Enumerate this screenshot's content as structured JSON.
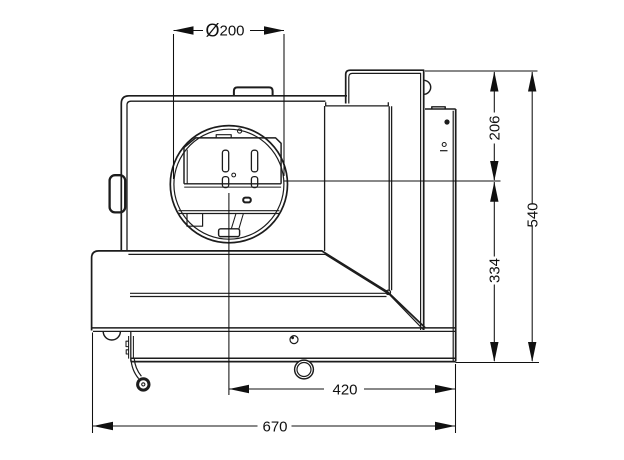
{
  "drawing": {
    "type": "technical-dimension-drawing",
    "subject": "stove side view with flue outlet",
    "colors": {
      "background": "#ffffff",
      "line": "#1c1c1c",
      "dimension": "#101010"
    },
    "dimensions": {
      "flue_diameter": {
        "symbol": "Ø",
        "value": "200"
      },
      "top_to_flue_center": {
        "value": "206"
      },
      "flue_center_to_base": {
        "value": "334"
      },
      "total_height": {
        "value": "540"
      },
      "flue_center_to_front": {
        "value": "420"
      },
      "total_width": {
        "value": "670"
      }
    }
  }
}
